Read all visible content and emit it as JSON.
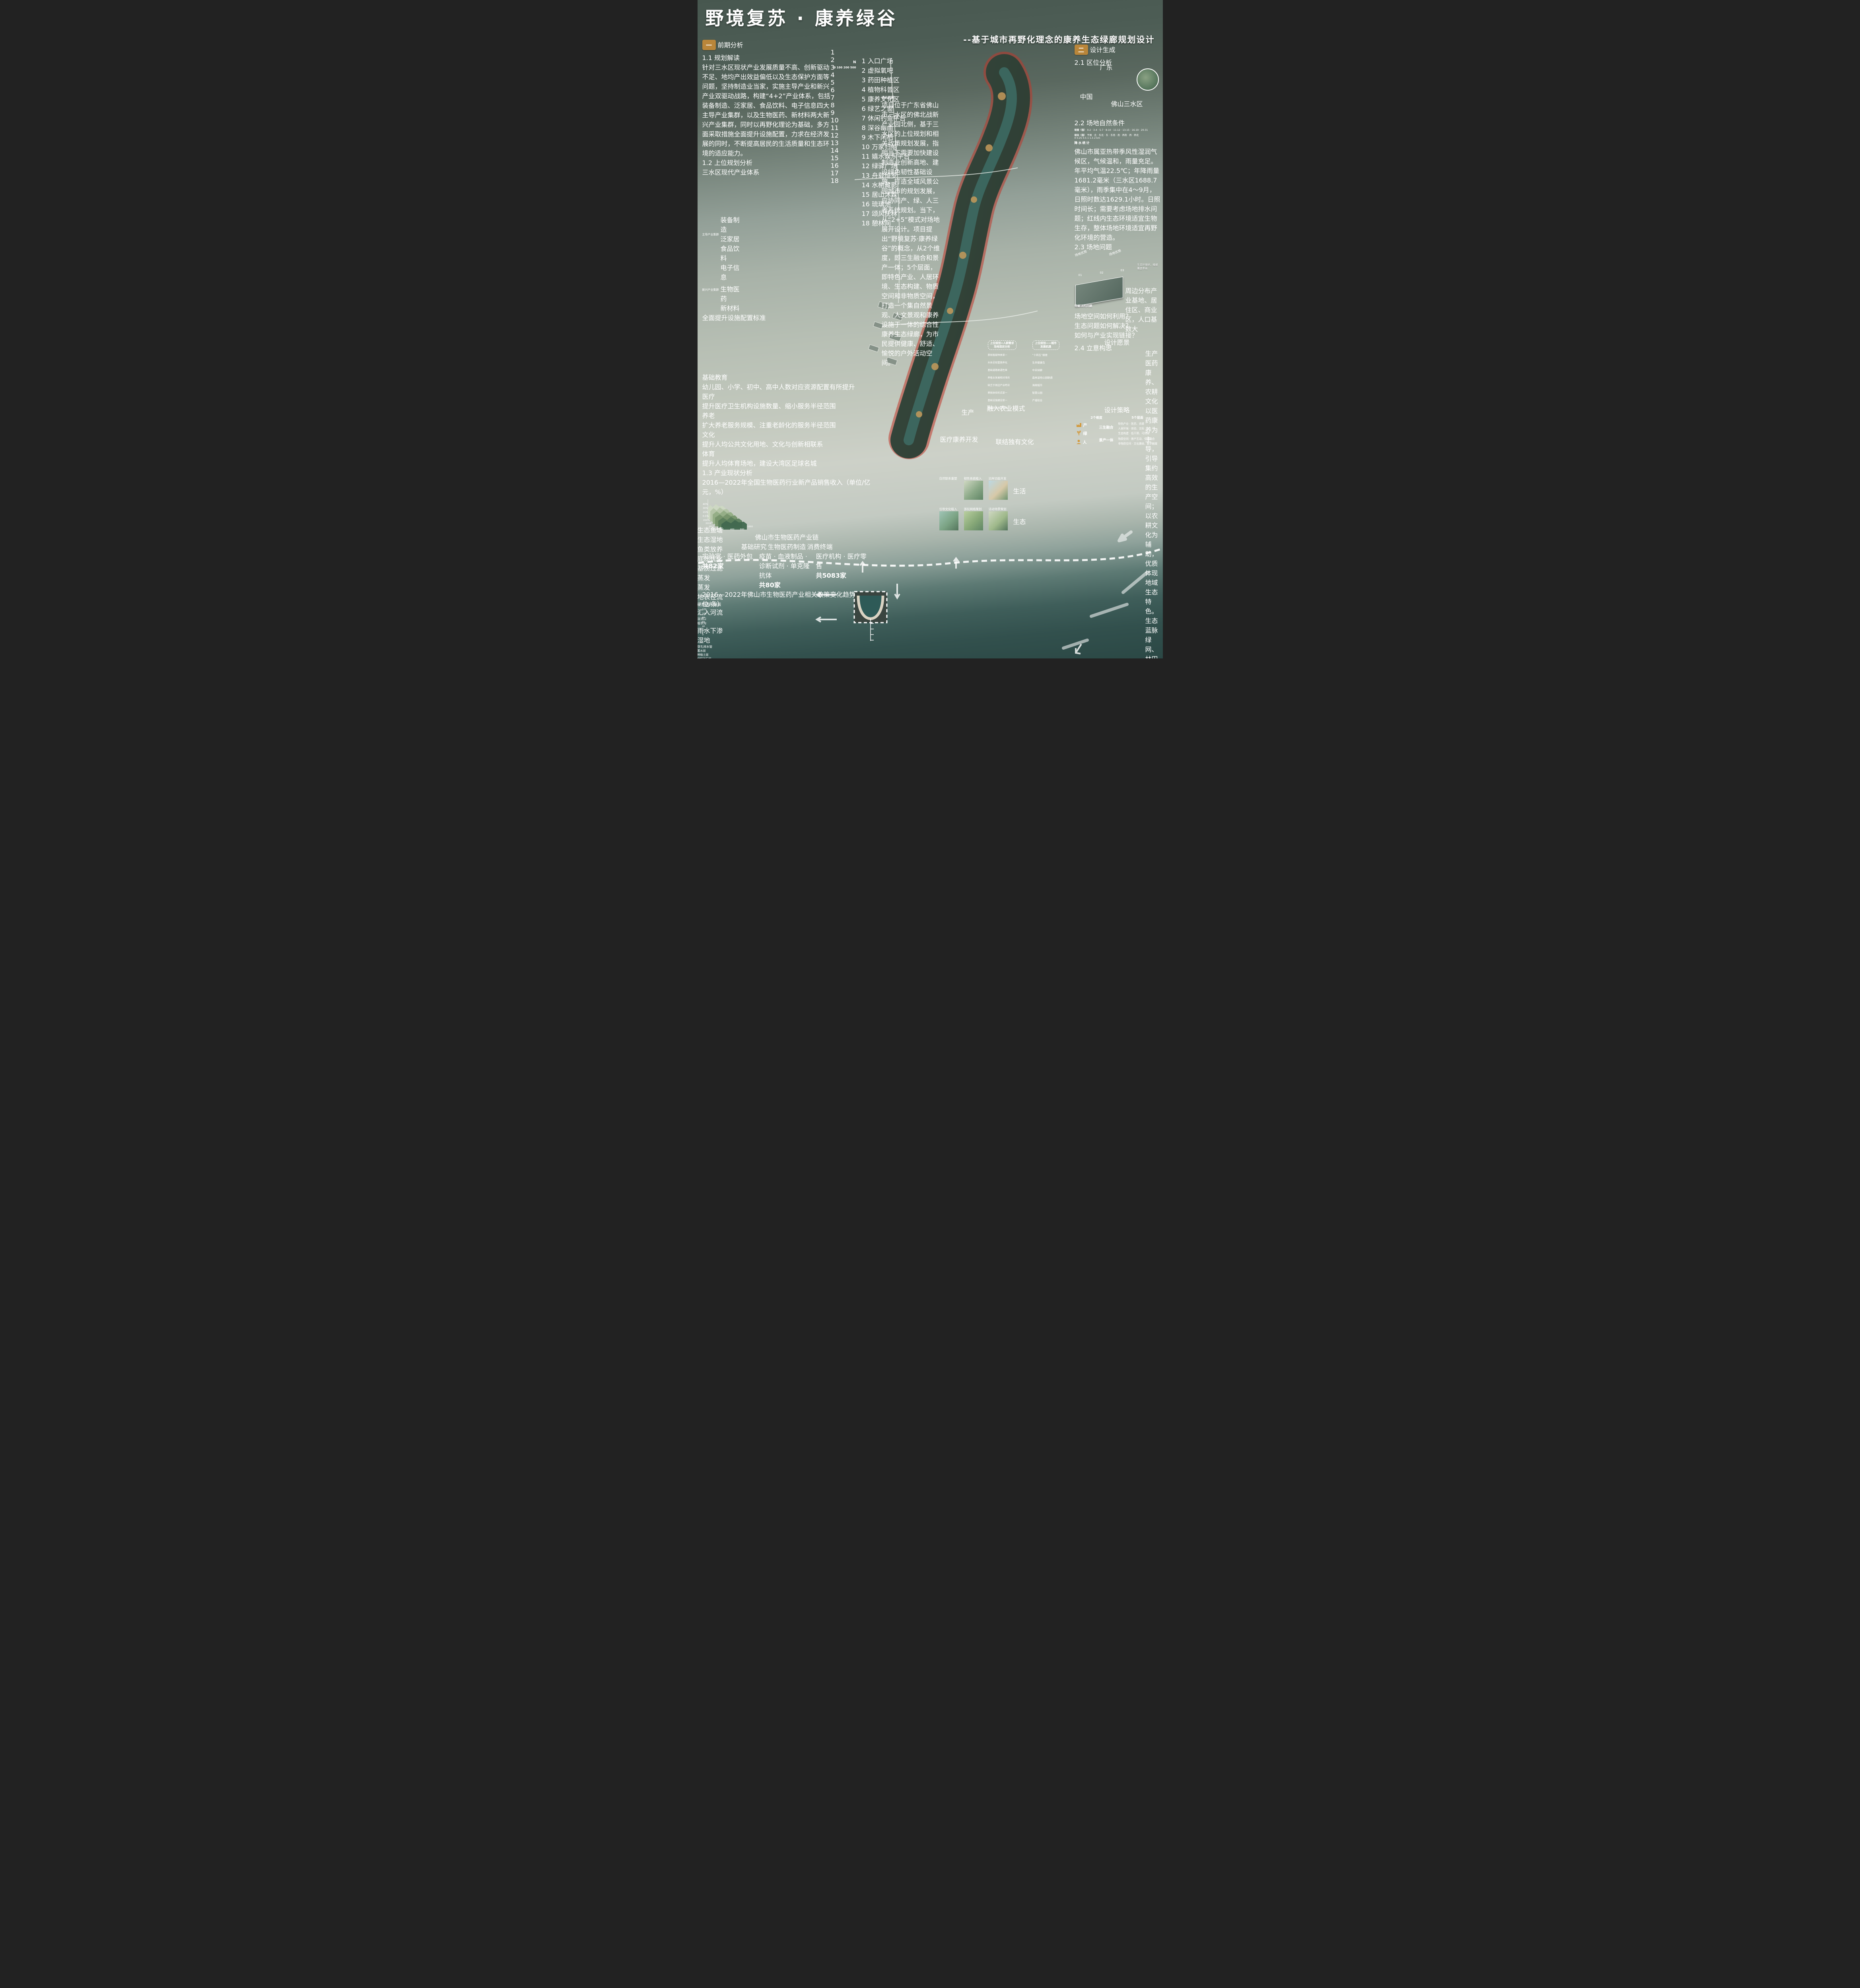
{
  "header": {
    "title": "野境复苏 · 康养绿谷",
    "subtitle": "--基于城市再野化理念的康养生态绿廊规划设计"
  },
  "section1": {
    "num": "一",
    "title": "前期分析"
  },
  "section2": {
    "num": "二",
    "title": "设计生成"
  },
  "s11": {
    "heading": "1.1 规划解读",
    "body": "针对三水区现状产业发展质量不高、创新驱动不足、地均产出效益偏低以及生态保护方面等问题，坚持制造业当家，实施主导产业和新兴产业双驱动战路，构建“4+2”产业体系，包括装备制造、泛家居、食品饮料、电子信息四大主导产业集群，以及生物医药、新材料两大新兴产业集群，同时以再野化理论为基础，多方面采取措施全面提升设施配置，力求在经济发展的同时，不断提高居民的生活质量和生态环境的适应能力。"
  },
  "s12": {
    "heading": "1.2 上位规划分析",
    "root": "三水区现代产业体系",
    "cluster1": "主导产业集群",
    "cluster1_items": [
      "装备制造",
      "泛家居",
      "食品饮料",
      "电子信息"
    ],
    "cluster2": "新兴产业集群",
    "cluster2_items": [
      "生物医药",
      "新材料"
    ],
    "mid": "全面提升设施配置标准",
    "rows": [
      {
        "label": "基础教育",
        "desc": "幼儿园、小学、初中、高中人数对应资源配置有所提升"
      },
      {
        "label": "医疗",
        "desc": "提升医疗卫生机构设施数量、缩小服务半径范围"
      },
      {
        "label": "养老",
        "desc": "扩大养老服务规模、注重老龄化的服务半径范围"
      },
      {
        "label": "文化",
        "desc": "提升人均公共文化用地、文化与创新相联系"
      },
      {
        "label": "体育",
        "desc": "提升人均体育场地，建设大湾区足球名城"
      }
    ]
  },
  "s13": {
    "heading": "1.3 产业现状分析",
    "chart1_title": "2016—2022年全国生物医药行业新产品销售收入（单位/亿元，%）",
    "chart1_yticks": [
      "40%",
      "30%",
      "15%",
      "0.5%"
    ],
    "chart1_years": [
      "2021",
      "2020",
      "2019",
      "2018",
      "2017",
      "2016"
    ],
    "chart1_xticks": [
      "0",
      "200",
      "400",
      "600",
      "800",
      "1000"
    ],
    "chain_title": "佛山市生物医药产业链",
    "chain_stages": [
      "基础研究",
      "生物医药制造",
      "消费终端"
    ],
    "chain_cols": [
      {
        "items": "实验室 · 医药外包",
        "count": "共82家"
      },
      {
        "items": "疫苗 · 血液制品 · 诊断试剂 · 单克隆抗体",
        "count": "共80家"
      },
      {
        "items": "医疗机构 · 医疗零售",
        "count": "共5083家"
      }
    ],
    "chart2_title": "2016—2022年佛山市生物医药产业相关政策变化趋势（单位/条）",
    "note1": "2016-2020年期间我国生物医药行业新产品销售规模呈较快增长趋势；生物医药产业价值链集中分布在生物医药制造环节。",
    "note2": "在政策指引和市场需求的驱动下，佛山市生物医药产业链不断完善，具有较为广阔的下游生物医药应用场景。",
    "note3": "《广佛全域同城化“十四五”发展规划》提出打造生物医药与健康产业等万亿级产业集群，同时佛山政府推出了多项促进佛山生物医药产业发展的政策。"
  },
  "chart_data": [
    {
      "type": "area",
      "title": "2016—2022年全国生物医药行业新产品销售收入（单位/亿元，%）",
      "ylabel_ticks": [
        "40%",
        "30%",
        "15%",
        "0.5%"
      ],
      "x_ticks": [
        0,
        200,
        400,
        600,
        800,
        1000
      ],
      "series_years": [
        2016,
        2017,
        2018,
        2019,
        2020,
        2021
      ],
      "note": "3D ridge/area chart, values approximate from pixels"
    },
    {
      "type": "bar",
      "title": "2016—2022年佛山市生物医药产业相关政策变化趋势（单位/条）",
      "categories": [
        "2016",
        "2017",
        "2018",
        "2019",
        "2020",
        "2021",
        "2022"
      ],
      "values": [
        40,
        42,
        90,
        95,
        25,
        20,
        58
      ],
      "ylim": [
        0,
        120
      ],
      "y_ticks": [
        0,
        20,
        40,
        60,
        80,
        100,
        120
      ]
    }
  ],
  "s14": {
    "heading": "1.4 用地性质分析",
    "scale_ticks": "0  100 200        500",
    "legend_roads": [
      {
        "label": "广佛肇高速",
        "color": "#c9a84c"
      },
      {
        "label": "云东海大道",
        "color": "#cf4a42"
      },
      {
        "label": "学海北路",
        "color": "#8a5a2a"
      },
      {
        "label": "龙岩路",
        "color": "#d9924e"
      },
      {
        "label": "紫云路 🚍 公交站",
        "color": "#7aa96a"
      },
      {
        "label": "鹅影路 Ⓟ 服务区",
        "color": "#3f8f85"
      },
      {
        "label": "内部交通",
        "color": "#86c3cf"
      }
    ],
    "entry_label": "出入口",
    "legend_land": [
      {
        "label": "农作物区",
        "color": "#c98f62"
      },
      {
        "label": "居住绿植区",
        "color": "#55663f"
      },
      {
        "label": "林地区",
        "color": "#6d7a55"
      },
      {
        "label": "文化娱乐用地",
        "color": "#d9a06a"
      },
      {
        "label": "商业金融用地",
        "color": "#9ab98a"
      },
      {
        "label": "行政办公用地",
        "color": "#e8ece7"
      },
      {
        "label": "居住用地",
        "color": "#8fa878"
      },
      {
        "label": "特殊用地",
        "color": "#5d554f"
      }
    ],
    "body": "通过城市再野化策略，实现生态环境的复苏，促进场地的可持续发展。场地主要是为人们提供生产性生活的功能，满足人群休闲、消费、健康等方面需求；利用场地文化宜居桑基鱼塘和医药产业的运营模式，植入智能化为人们日常生活提供便利，发挥全面的规划优势。迎合野化的模式，激活场地复苏，将野性自然生态系统与城市人居环境、水系统有机结合，从而创造出更绿色、可持续的“野性城市”，在保障生物多样性的同时，促进城市居民健康。作为千亩湿地、万亩森林和万亩产业的活力纽带，强化健康产业康养设施，提升中央绿谷的社会经济效益。"
  },
  "s15": {
    "heading": "1.5 场地印象",
    "items": [
      {
        "title": "宗祠文化——祖祠",
        "desc": "三水区有很多古宗祠，其不仅是家族的象征，也是研究地方历史文化和建筑艺术的重要资料。"
      },
      {
        "title": "陶瓷文化——石湾陶艺",
        "desc": "具有一定的艺术价值和实用价值。"
      },
      {
        "title": "节日文化——赛龙舟",
        "desc": "三水区的龙舟竞渡活动，端午节期间都会举办大型的竞赛活动。"
      },
      {
        "title": "武术文化——洪拳",
        "desc": "佛山是南派武术的发源地之一，三水也传承了丰富的武术文化，如洪拳、蔡李佛拳等。"
      },
      {
        "title": "民俗文化——舞狮",
        "desc": "地方特色的庆祝活动，它的出现可以追溯到唐代的宫廷狮子舞，寓意着人们美好的愿望。"
      },
      {
        "title": "农耕文化——桑基鱼塘",
        "desc": "桑基鱼塘是当地的一种传统农业生态系统，具有悠久的历史和独特的生态价值。这种模式将桑树种植与养鱼相结合，形成了一个高效循环的生态系统。"
      },
      {
        "title": "饮食文化——三水四绝",
        "desc": "三水区以其独特的粤菜闻名。"
      },
      {
        "title": "景观文化——云东海国家湿地公园",
        "desc": "城市的后花园，一片疗愈心灵的地方。"
      }
    ]
  },
  "s16": {
    "heading": "1.6 人群分析",
    "groups": [
      {
        "name": "园区职工",
        "tags": [
          "研学",
          "管理",
          "种植",
          "放松",
          "健身"
        ]
      },
      {
        "name": "社区居民",
        "tags": [
          "嬉戏",
          "散步",
          "观赏",
          "锻炼"
        ]
      },
      {
        "name": "学生群体",
        "tags": [
          "游玩",
          "探险",
          "学习",
          "科教",
          "运动"
        ]
      },
      {
        "name": "商务人士",
        "tags": [
          "休息",
          "社交",
          "创作",
          "交流",
          "思考"
        ]
      },
      {
        "name": "游客",
        "tags": [
          "打卡",
          "休闲",
          "观光",
          "购物"
        ]
      },
      {
        "name": "艺术家",
        "tags": [
          "采风",
          "冥想",
          "写生",
          "观察"
        ]
      }
    ]
  },
  "map": {
    "north": "N",
    "scale_ticks": "0  100 200       500",
    "legend": [
      "入口广场",
      "虚拟氧吧",
      "药田种植区",
      "植物科普区",
      "康养文化区",
      "绿艺之窗",
      "休闲钓鱼平台",
      "深谷幽曲",
      "木下闲栖",
      "万家归船",
      "嬉水娱乐平台",
      "绿驿广场",
      "舟载绮罗",
      "水榭藏影",
      "居山沐霖",
      "琉璃池",
      "颂风抚林",
      "憩林间"
    ],
    "desc_title": "设计说明：",
    "desc": "项目位于广东省佛山市三水区的佛北战新产业园北侧，基于三水区的上位规划和相关政策规划发展，指明当下需要加快建设制造业创新高地、建设绿色韧性基础设施、打造全域风景公园城市的规划发展，应协同产、绿、人三者系统规划。当下，从“2+5”模式对场地展开设计。项目提出“野境复苏·康养绿谷”的概念，从2个维度，即三生融合和景产一体；5个层面，即特色产业、人居环境、生态构建、物质空间和非物质空间，打造一个集自然景观、人文景观和康养设施于一体的综合性康养生态绿廊，为市民提供健康、舒适、愉悦的户外活动空间。"
  },
  "s21": {
    "heading": "2.1 区位分析",
    "labels": [
      "中国",
      "广东",
      "佛山三水区"
    ]
  },
  "s22": {
    "heading": "2.2 场地自然条件",
    "slope_title": "坡度〈值〉",
    "slope_classes": "0-2 · 3-4 · 5-7 · 8-10 · 11-12 · 13-15 · 16-19 · 20-31",
    "aspect_title": "坡向〈值〉",
    "aspect_classes": "平面 · 北 · 东北 · 东 · 东南 · 南 · 西南 · 西 · 西北",
    "km_scale": "0  0.25 0.5    1    1.5    2 km",
    "rain_label": "降水统计",
    "caption": "佛山市属亚热带季风性湿润气候区，气候温和，雨量充足。年平均气温22.5℃；年降雨量1681.2毫米（三水区1688.7毫米），雨季集中在4～9月，日照时数达1629.1小时。日照时间长；需要考虑场地排水问题；红线内生态环境适宜生物生存，整体场地环境适宜再野化环境的营造。"
  },
  "s23": {
    "heading": "2.3 场地问题",
    "advantage_label": "场地优势",
    "advantage_label2": "场地优势",
    "problem_label": "待解决的问题",
    "photos": [
      "01",
      "02",
      "03"
    ],
    "note_right": "生态环境好，植被覆盖率高",
    "note_bottom": "周边分布产业基地、居住区、商业区，人口基数大",
    "questions": [
      "场地空间如何利用？",
      "生态问题如何解决？",
      "如何与产业实现链接？"
    ]
  },
  "s24": {
    "heading": "2.4 立意构思",
    "vision_title": "设计愿景",
    "flow1": "中央绿廊",
    "flow2": "生态绿心",
    "flow3": "生产、生态、生活相弥合",
    "plus": "＋",
    "pillars": [
      {
        "name": "生产",
        "sub": "医药康养、农耕文化",
        "desc": "以医药康养为主导，引导集约高效的生产空间；以农耕文化为辅助，优质体现地域生态特色。"
      },
      {
        "name": "生态",
        "sub": "蓝脉绿网、林田相依",
        "desc": "保证各片区生态因借有序；协调整体风貌，塑造绿地形象。"
      },
      {
        "name": "生活",
        "sub": "活力触媒、上新新生",
        "desc": "注重人文建设，侧面激发生产动力；数字智慧共享，空间活力进一步激发。"
      }
    ]
  },
  "panels": {
    "left_title1": "上位规划+人群需求",
    "left_title2": "场地现状分析",
    "left_items": [
      "景观植被种类单一",
      "水体呈现富营养化",
      "基础道路联通性差",
      "养殖业发展相对滞后",
      "缺乏于周边产业呼应",
      "景观体验形式单一",
      "基础设施建设单一",
      "基本游玩满足性差"
    ],
    "right_title1": "上位规划——城市",
    "right_title2": "发展机遇",
    "right_items": [
      "“十四五”纲要",
      "生命健康岛",
      "中央绿廊",
      "森林湿地公园联通",
      "海绵城市",
      "智慧公园",
      "产城结合"
    ]
  },
  "strategy": {
    "title": "设计策略",
    "dims_label": "2个维度",
    "layers_label": "5个层面",
    "row1": "产",
    "row2": "绿",
    "row3": "人",
    "dim1": "三生融合",
    "dim1_layers": [
      "特色产业 · 医药、农耕",
      "人居环境 · 体验、交际",
      "生态构建 · 低干预、可持续"
    ],
    "dim2": "景产一体",
    "dim2_layers": [
      "物质空间 · 景产互动、空间融合",
      "非物质空间 · 文化赓续、数字触媒"
    ]
  },
  "blocks": {
    "production_label": "生产",
    "production": [
      "融入农业模式",
      "医疗康养开发",
      "联结独有文化"
    ],
    "life_label": "生活",
    "life": [
      "自然联系重塑",
      "韧性系统植入",
      "沿岸功能开发"
    ],
    "eco_label": "生态",
    "eco": [
      "引导文化植入",
      "游玩网络策划",
      "活动场景策划"
    ]
  },
  "bottom": {
    "wetland_title": "生态湿地",
    "pond_title": "生态鱼塘",
    "evap1": "蒸发",
    "evap2": "蒸发",
    "surface_runoff": "地表径流",
    "permeable": "硬质透水铺装",
    "to_river": "汇入河流",
    "overflow": "溢流口",
    "grass_ditch": "植草沟",
    "rain_infiltrate": "雨水下渗",
    "wetland": "湿地",
    "perforated_pipe": "穿孔排水管",
    "layers": [
      "蓄水层",
      "种植土层",
      "级配碎石层",
      "生态鱼塘"
    ],
    "fish_stock": "鱼类放养",
    "substrate_opt": "底质优化",
    "matrix_filter": "基质过滤",
    "purify_air": "净化空气",
    "drain_channel": "排水沟渠",
    "underground_flow": "地下径流",
    "retention_area": "生态滞留区",
    "purify_system": "层级净化系统",
    "infiltration": "下渗"
  }
}
